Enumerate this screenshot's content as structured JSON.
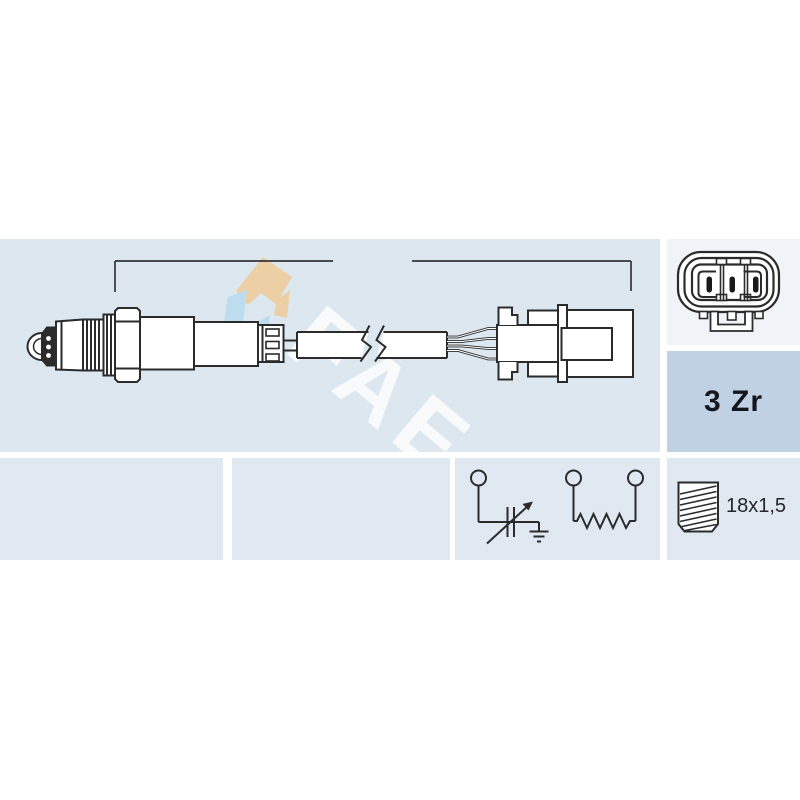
{
  "title": "Oxygen sensor technical diagram",
  "dimension": {
    "label": "450 mm"
  },
  "spec_box": {
    "label": "3 Zr"
  },
  "thread_box": {
    "label": "18x1,5"
  },
  "watermark": {
    "text": "FAE"
  },
  "colors": {
    "panel_blue": "#dce7f0",
    "bottom_panel_blue": "#e0e8f1",
    "spec_panel_blue": "#bfd1e3",
    "connector_panel": "#f0f4f8",
    "line": "#2b2b2b",
    "text": "#24262b",
    "logo_tan": "#eccfa4",
    "logo_blue": "#bddcee",
    "watermark_white": "rgba(255,255,255,0.8)"
  },
  "icons": {
    "sensor_drawing": "oxygen-sensor-side-view",
    "cable_break": "cable-break-zigzag",
    "dimension_line": "dimension-line-450mm",
    "connector_face": "3-pin-oval-connector-face",
    "circuit_left": "zirconia-cell-variable-with-ground",
    "circuit_right": "heater-resistor-two-terminals",
    "thread": "thread-bolt-18x1-5",
    "watermark": "fae-logo-watermark"
  }
}
